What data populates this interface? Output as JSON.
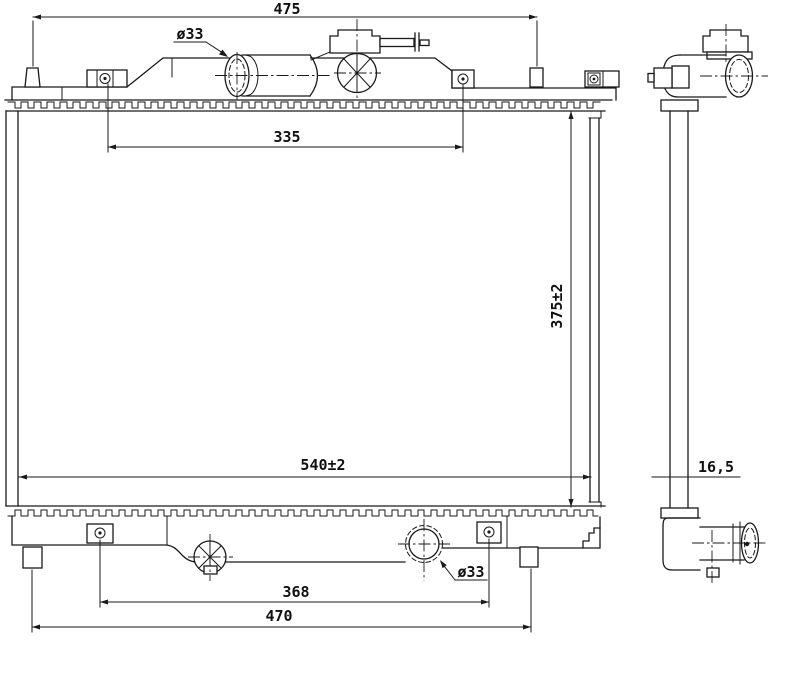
{
  "drawing": {
    "dimensions": {
      "top_width": "475",
      "inlet_diameter": "ø33",
      "port_span": "335",
      "core_height": "375±2",
      "core_width": "540±2",
      "outlet_diameter": "ø33",
      "bracket_span": "368",
      "bottom_width": "470",
      "core_depth": "16,5"
    },
    "colors": {
      "line": "#1a1a1a",
      "background": "#ffffff"
    }
  }
}
